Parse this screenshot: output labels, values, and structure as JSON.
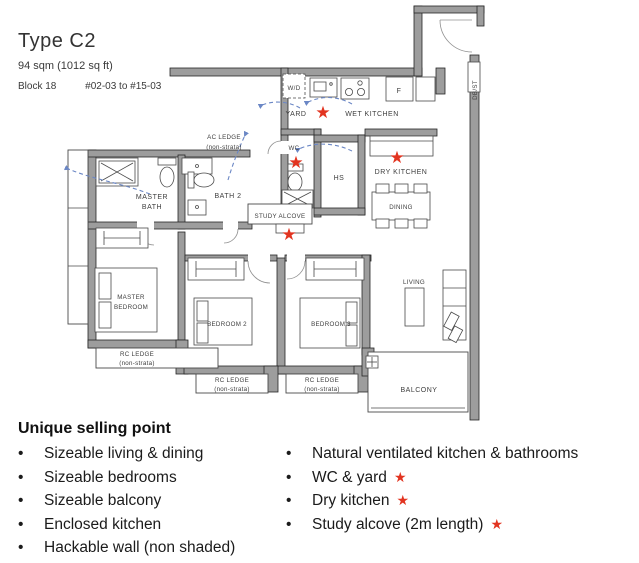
{
  "header": {
    "type_label": "Type C2",
    "area": "94 sqm (1012 sq ft)",
    "block": "Block 18",
    "units": "#02-03 to #15-03"
  },
  "plan": {
    "star_glyph": "★",
    "colors": {
      "star": "#e23420",
      "wall": "#9d9d9d",
      "arrow": "#6b87c5"
    },
    "labels": {
      "wd": "W/D",
      "yard": "YARD",
      "wet_kitchen": "WET KITCHEN",
      "fridge": "F",
      "dbst": "DB/ST",
      "ac_ledge_1": "AC LEDGE",
      "ac_ledge_2": "(non-strata)",
      "wc": "WC",
      "hs": "HS",
      "dry_kitchen": "DRY KITCHEN",
      "dining": "DINING",
      "master_bath_1": "MASTER",
      "master_bath_2": "BATH",
      "bath2": "BATH 2",
      "study_alcove": "STUDY ALCOVE",
      "master_bedroom_1": "MASTER",
      "master_bedroom_2": "BEDROOM",
      "bedroom2": "BEDROOM 2",
      "bedroom3": "BEDROOM 3",
      "living": "LIVING",
      "balcony": "BALCONY",
      "rc_ledge_1": "RC LEDGE",
      "rc_ledge_2": "(non-strata)"
    }
  },
  "selling_points": {
    "title": "Unique selling point",
    "bullet_glyph": "•",
    "left": [
      "Sizeable living & dining",
      "Sizeable bedrooms",
      "Sizeable balcony",
      "Enclosed kitchen",
      "Hackable wall (non shaded)"
    ],
    "right": [
      {
        "text": "Natural ventilated kitchen & bathrooms",
        "star": false
      },
      {
        "text": "WC & yard",
        "star": true
      },
      {
        "text": "Dry kitchen",
        "star": true
      },
      {
        "text": "Study alcove (2m length)",
        "star": true
      }
    ]
  }
}
